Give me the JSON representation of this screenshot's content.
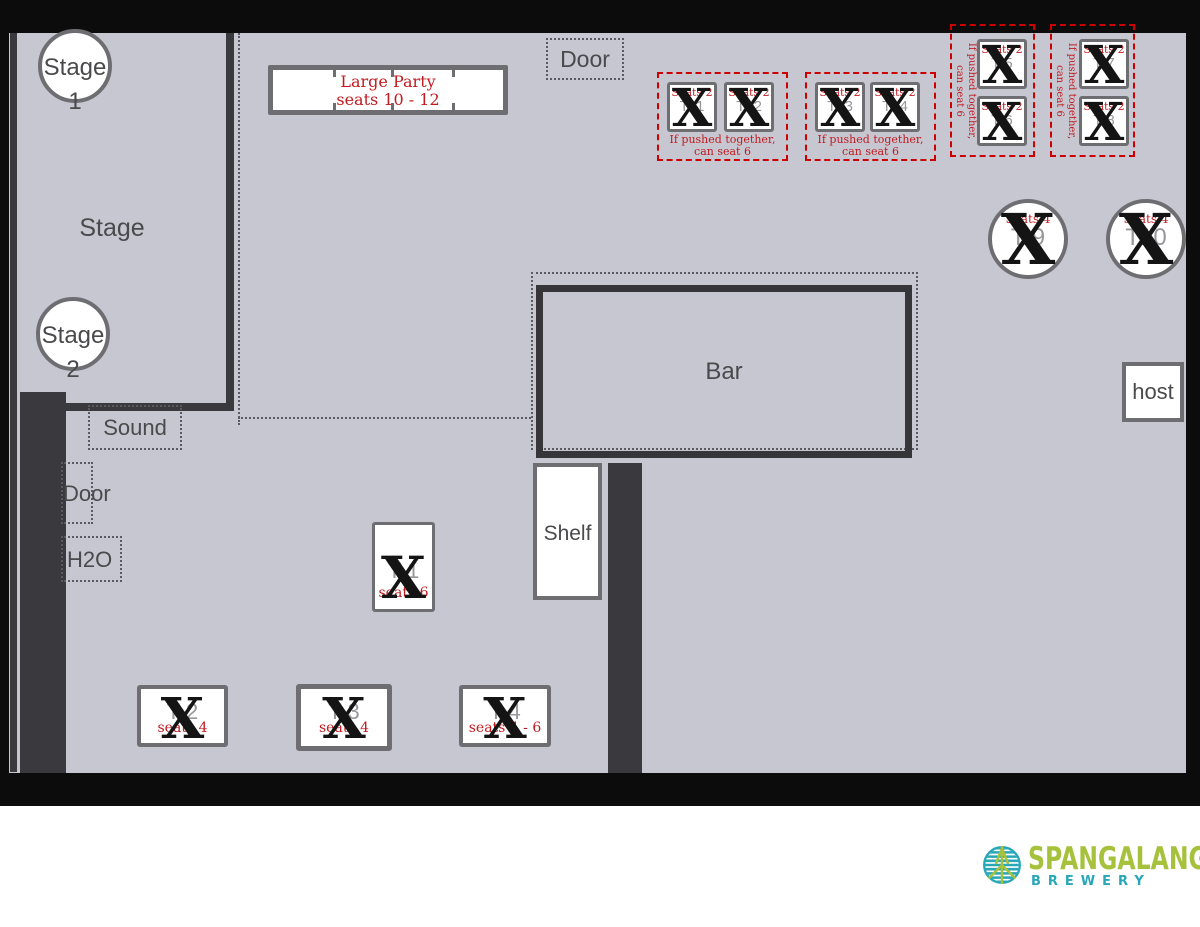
{
  "palette": {
    "floor": "#c6c7d1",
    "wall_dark": "#3a3a3e",
    "frame_black": "#0c0c0c",
    "table_border": "#6e6e72",
    "annotation_red": "#c01b20",
    "dashed_red": "#cc0000",
    "label_gray": "#4a4a4c",
    "table_label_gray": "#97979c",
    "logo_green": "#a6c23c",
    "logo_teal": "#28a7b8"
  },
  "cross_glyph": "X",
  "rooms": {
    "stage_area_label": "Stage",
    "stage1": {
      "line1": "Stage",
      "line2": "1"
    },
    "stage2": {
      "line1": "Stage",
      "line2": "2"
    },
    "sound_label": "Sound",
    "door_left_label": "Door",
    "h2o_label": "H2O",
    "door_top_label": "Door",
    "bar_label": "Bar",
    "shelf_label": "Shelf",
    "host_label": "host"
  },
  "large_party_table": {
    "title": "Large Party",
    "seats": "seats 10 - 12"
  },
  "group_note": {
    "line1": "If pushed together,",
    "line2": "can seat 6"
  },
  "tables": {
    "t1": {
      "label": "T 1",
      "seats": "seats 6"
    },
    "t2": {
      "label": "T 2",
      "seats": "seats 4"
    },
    "t3": {
      "label": "T 3",
      "seats": "seats 4"
    },
    "t4": {
      "label": "T 4",
      "seats": "seats 4 - 6"
    },
    "t5": {
      "label": "T 5",
      "seats": "Seats 2"
    },
    "t6": {
      "label": "T 6",
      "seats": "Seats 2"
    },
    "t7": {
      "label": "T 7",
      "seats": "Seats 2"
    },
    "t8": {
      "label": "T 8",
      "seats": "Seats 2"
    },
    "t9": {
      "label": "T 9",
      "seats": "Seats 4"
    },
    "t10": {
      "label": "T10",
      "seats": "Seats 4"
    },
    "t11": {
      "label": "T11",
      "seats": "Seats 2"
    },
    "t12": {
      "label": "T12",
      "seats": "Seats 2"
    },
    "t13": {
      "label": "T13",
      "seats": "Seats 2"
    },
    "t14": {
      "label": "T14",
      "seats": "Seats 2"
    }
  },
  "logo": {
    "brand": "SPANGALANG",
    "subtitle": "BREWERY"
  }
}
